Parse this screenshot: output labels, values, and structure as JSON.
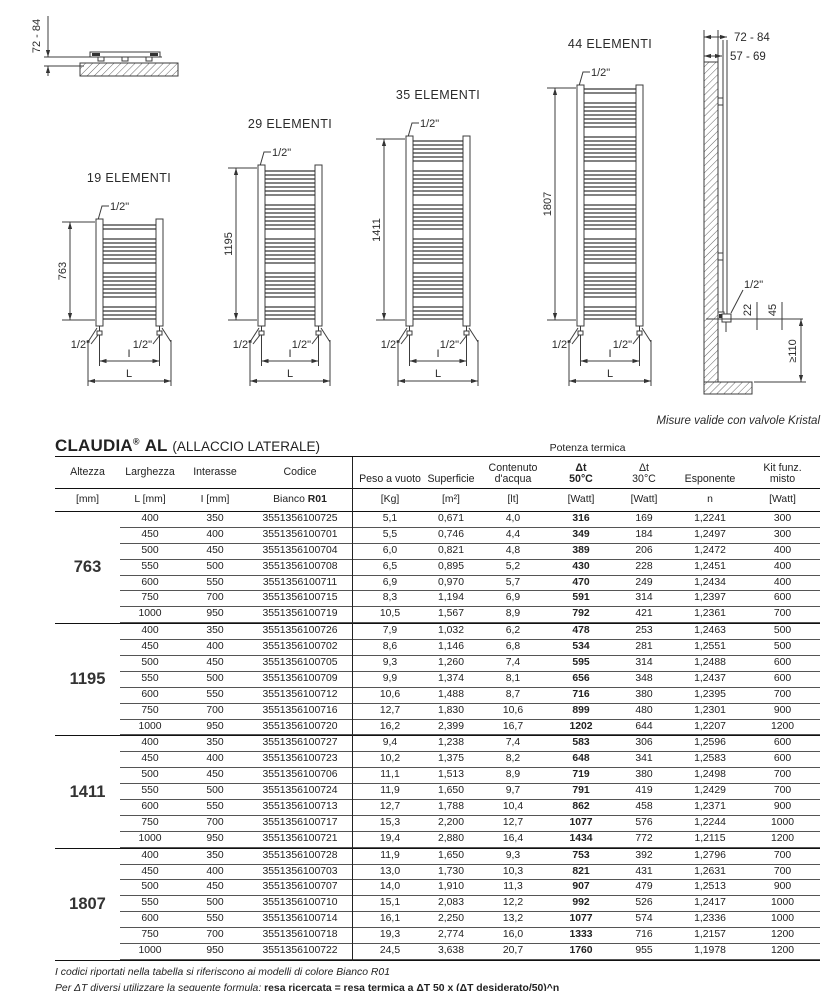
{
  "drawings": {
    "top_view": {
      "dim": "72 - 84"
    },
    "conn_label": "1/2\"",
    "dim_inner_label": "I",
    "dim_outer_label": "L",
    "radiators": [
      {
        "label": "19 ELEMENTI",
        "height": "763"
      },
      {
        "label": "29 ELEMENTI",
        "height": "1195"
      },
      {
        "label": "35 ELEMENTI",
        "height": "1411"
      },
      {
        "label": "44 ELEMENTI",
        "height": "1807"
      }
    ],
    "side_view": {
      "dim_wall_1": "72 - 84",
      "dim_wall_2": "57 - 69",
      "valve_label": "1/2\"",
      "dim_offset": "22",
      "dim_valve": "45",
      "dim_floor": "≥110"
    },
    "caption": "Misure valide con valvole Kristal"
  },
  "title": {
    "brand": "CLAUDIA",
    "reg": "®",
    "model": "AL",
    "suffix": "(ALLACCIO LATERALE)"
  },
  "table": {
    "potenza_label": "Potenza termica",
    "head": {
      "altezza": "Altezza",
      "larghezza": "Larghezza",
      "interasse": "Interasse",
      "codice": "Codice",
      "peso": "Peso a vuoto",
      "superficie": "Superficie",
      "contenuto": "Contenuto\nd'acqua",
      "dt50": "Δt\n50°C",
      "dt30": "Δt\n30°C",
      "esponente": "Esponente",
      "kit": "Kit funz.\nmisto"
    },
    "units": {
      "altezza": "[mm]",
      "larghezza": "L [mm]",
      "interasse": "I [mm]",
      "codice_prefix": "Bianco ",
      "codice_bold": "R01",
      "peso": "[Kg]",
      "superficie": "[m²]",
      "contenuto": "[lt]",
      "dt50": "[Watt]",
      "dt30": "[Watt]",
      "esponente": "n",
      "kit": "[Watt]"
    },
    "groups": [
      {
        "altezza": "763",
        "rows": [
          [
            "400",
            "350",
            "3551356100725",
            "5,1",
            "0,671",
            "4,0",
            "316",
            "169",
            "1,2241",
            "300"
          ],
          [
            "450",
            "400",
            "3551356100701",
            "5,5",
            "0,746",
            "4,4",
            "349",
            "184",
            "1,2497",
            "300"
          ],
          [
            "500",
            "450",
            "3551356100704",
            "6,0",
            "0,821",
            "4,8",
            "389",
            "206",
            "1,2472",
            "400"
          ],
          [
            "550",
            "500",
            "3551356100708",
            "6,5",
            "0,895",
            "5,2",
            "430",
            "228",
            "1,2451",
            "400"
          ],
          [
            "600",
            "550",
            "3551356100711",
            "6,9",
            "0,970",
            "5,7",
            "470",
            "249",
            "1,2434",
            "400"
          ],
          [
            "750",
            "700",
            "3551356100715",
            "8,3",
            "1,194",
            "6,9",
            "591",
            "314",
            "1,2397",
            "600"
          ],
          [
            "1000",
            "950",
            "3551356100719",
            "10,5",
            "1,567",
            "8,9",
            "792",
            "421",
            "1,2361",
            "700"
          ]
        ]
      },
      {
        "altezza": "1195",
        "rows": [
          [
            "400",
            "350",
            "3551356100726",
            "7,9",
            "1,032",
            "6,2",
            "478",
            "253",
            "1,2463",
            "500"
          ],
          [
            "450",
            "400",
            "3551356100702",
            "8,6",
            "1,146",
            "6,8",
            "534",
            "281",
            "1,2551",
            "500"
          ],
          [
            "500",
            "450",
            "3551356100705",
            "9,3",
            "1,260",
            "7,4",
            "595",
            "314",
            "1,2488",
            "600"
          ],
          [
            "550",
            "500",
            "3551356100709",
            "9,9",
            "1,374",
            "8,1",
            "656",
            "348",
            "1,2437",
            "600"
          ],
          [
            "600",
            "550",
            "3551356100712",
            "10,6",
            "1,488",
            "8,7",
            "716",
            "380",
            "1,2395",
            "700"
          ],
          [
            "750",
            "700",
            "3551356100716",
            "12,7",
            "1,830",
            "10,6",
            "899",
            "480",
            "1,2301",
            "900"
          ],
          [
            "1000",
            "950",
            "3551356100720",
            "16,2",
            "2,399",
            "16,7",
            "1202",
            "644",
            "1,2207",
            "1200"
          ]
        ]
      },
      {
        "altezza": "1411",
        "rows": [
          [
            "400",
            "350",
            "3551356100727",
            "9,4",
            "1,238",
            "7,4",
            "583",
            "306",
            "1,2596",
            "600"
          ],
          [
            "450",
            "400",
            "3551356100723",
            "10,2",
            "1,375",
            "8,2",
            "648",
            "341",
            "1,2583",
            "600"
          ],
          [
            "500",
            "450",
            "3551356100706",
            "11,1",
            "1,513",
            "8,9",
            "719",
            "380",
            "1,2498",
            "700"
          ],
          [
            "550",
            "500",
            "3551356100724",
            "11,9",
            "1,650",
            "9,7",
            "791",
            "419",
            "1,2429",
            "700"
          ],
          [
            "600",
            "550",
            "3551356100713",
            "12,7",
            "1,788",
            "10,4",
            "862",
            "458",
            "1,2371",
            "900"
          ],
          [
            "750",
            "700",
            "3551356100717",
            "15,3",
            "2,200",
            "12,7",
            "1077",
            "576",
            "1,2244",
            "1000"
          ],
          [
            "1000",
            "950",
            "3551356100721",
            "19,4",
            "2,880",
            "16,4",
            "1434",
            "772",
            "1,2115",
            "1200"
          ]
        ]
      },
      {
        "altezza": "1807",
        "rows": [
          [
            "400",
            "350",
            "3551356100728",
            "11,9",
            "1,650",
            "9,3",
            "753",
            "392",
            "1,2796",
            "700"
          ],
          [
            "450",
            "400",
            "3551356100703",
            "13,0",
            "1,730",
            "10,3",
            "821",
            "431",
            "1,2631",
            "700"
          ],
          [
            "500",
            "450",
            "3551356100707",
            "14,0",
            "1,910",
            "11,3",
            "907",
            "479",
            "1,2513",
            "900"
          ],
          [
            "550",
            "500",
            "3551356100710",
            "15,1",
            "2,083",
            "12,2",
            "992",
            "526",
            "1,2417",
            "1000"
          ],
          [
            "600",
            "550",
            "3551356100714",
            "16,1",
            "2,250",
            "13,2",
            "1077",
            "574",
            "1,2336",
            "1000"
          ],
          [
            "750",
            "700",
            "3551356100718",
            "19,3",
            "2,774",
            "16,0",
            "1333",
            "716",
            "1,2157",
            "1200"
          ],
          [
            "1000",
            "950",
            "3551356100722",
            "24,5",
            "3,638",
            "20,7",
            "1760",
            "955",
            "1,1978",
            "1200"
          ]
        ]
      }
    ]
  },
  "footnotes": {
    "line1": "I codici riportati nella tabella si riferiscono ai modelli di colore Bianco R01",
    "line2_italic": "Per ΔT diversi utilizzare la seguente formula: ",
    "line2_formula": "resa ricercata = resa termica a ΔT 50 x (ΔT desiderato/50)^n"
  }
}
